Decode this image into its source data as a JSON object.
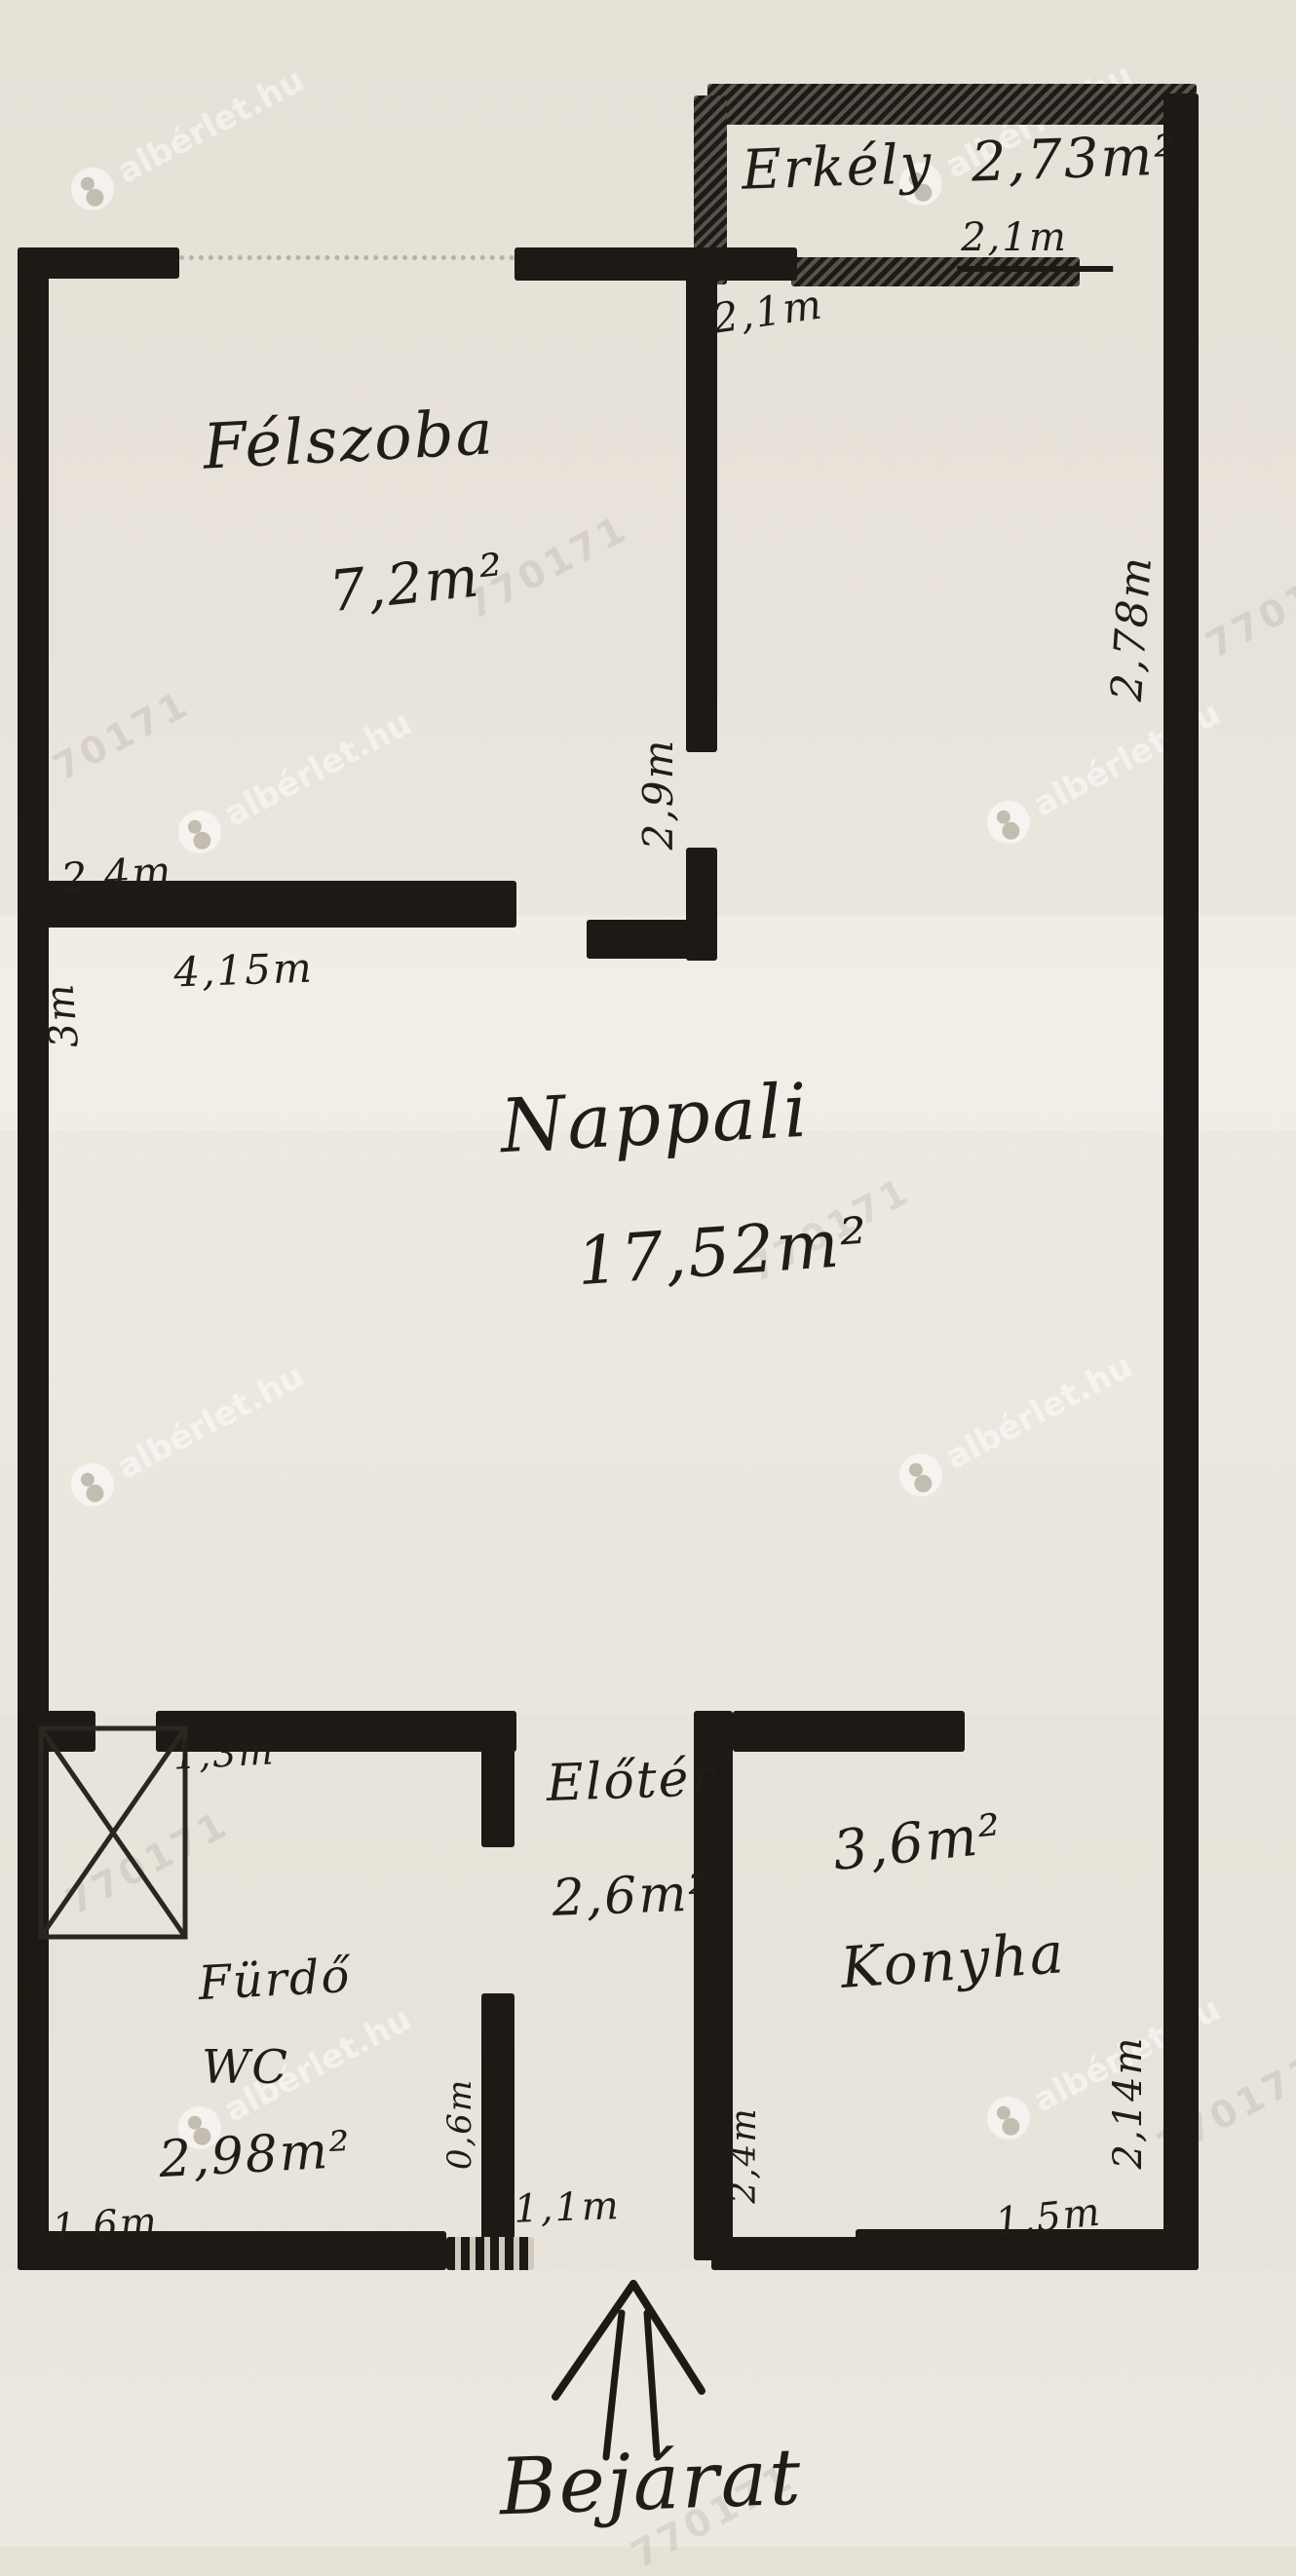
{
  "watermark": {
    "brand": "albérlet.hu",
    "code": "770171"
  },
  "rooms": {
    "erkely": {
      "label": "Erkély",
      "area": "2,73m²"
    },
    "felszoba": {
      "label": "Félszoba",
      "area": "7,2m²"
    },
    "nappali": {
      "label": "Nappali",
      "area": "17,52m²"
    },
    "eloter": {
      "label": "Előtér",
      "area": "2,6m²"
    },
    "konyha": {
      "label": "Konyha",
      "area": "3,6m²"
    },
    "furdo_wc": {
      "label_line1": "Fürdő",
      "label_line2": "WC",
      "area": "2,98m²"
    }
  },
  "dims": {
    "erkely_width": "2,1m",
    "erkely_door": "2,1m",
    "right_wall_upper": "2,78m",
    "felszoba_door": "2,9m",
    "felszoba_bottom_above": "2,4m",
    "felszoba_bottom_below": "4,15m",
    "nappali_left": "3m",
    "furdo_top": "1,3m",
    "furdo_bottom": "1,6m",
    "eloter_left": "0,6m",
    "eloter_bottom": "1,1m",
    "eloter_right": "2,4m",
    "konyha_right": "2,14m",
    "konyha_bottom": "1,5m"
  },
  "entrance": {
    "label": "Bejárat"
  }
}
